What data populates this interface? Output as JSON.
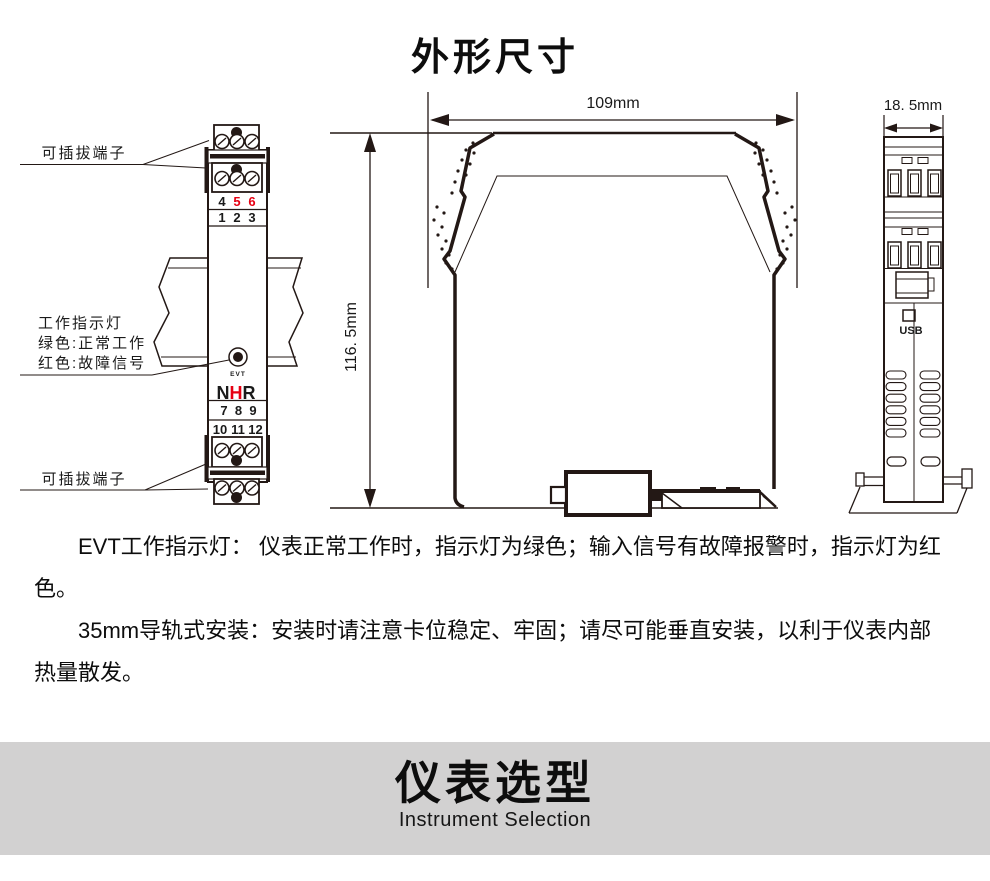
{
  "title": "外形尺寸",
  "left_view": {
    "top_terminal_label": "可插拔端子",
    "bottom_terminal_label": "可插拔端子",
    "indicator_label_line1": "工作指示灯",
    "indicator_label_line2": "绿色:正常工作",
    "indicator_label_line3": "红色:故障信号",
    "indicator_name": "EVT",
    "brand_n": "N",
    "brand_h": "H",
    "brand_r": "R",
    "terminals_row_a": [
      "4",
      "5",
      "6"
    ],
    "terminals_row_b": [
      "1",
      "2",
      "3"
    ],
    "terminals_row_c": [
      "7",
      "8",
      "9"
    ],
    "terminals_row_d": [
      "10",
      "11",
      "12"
    ]
  },
  "dimensions": {
    "width": "109mm",
    "height": "116. 5mm",
    "depth": "18. 5mm"
  },
  "right_view": {
    "usb_label": "USB"
  },
  "notes": [
    "EVT工作指示灯： 仪表正常工作时，指示灯为绿色；输入信号有故障报警时，指示灯为红色。",
    "35mm导轨式安装：安装时请注意卡位稳定、牢固；请尽可能垂直安装，以利于仪表内部热量散发。"
  ],
  "banner": {
    "title": "仪表选型",
    "subtitle": "Instrument Selection"
  },
  "colors": {
    "accent_red": "#e60012",
    "line_color": "#231815",
    "banner_bg": "#d2d1d1"
  }
}
